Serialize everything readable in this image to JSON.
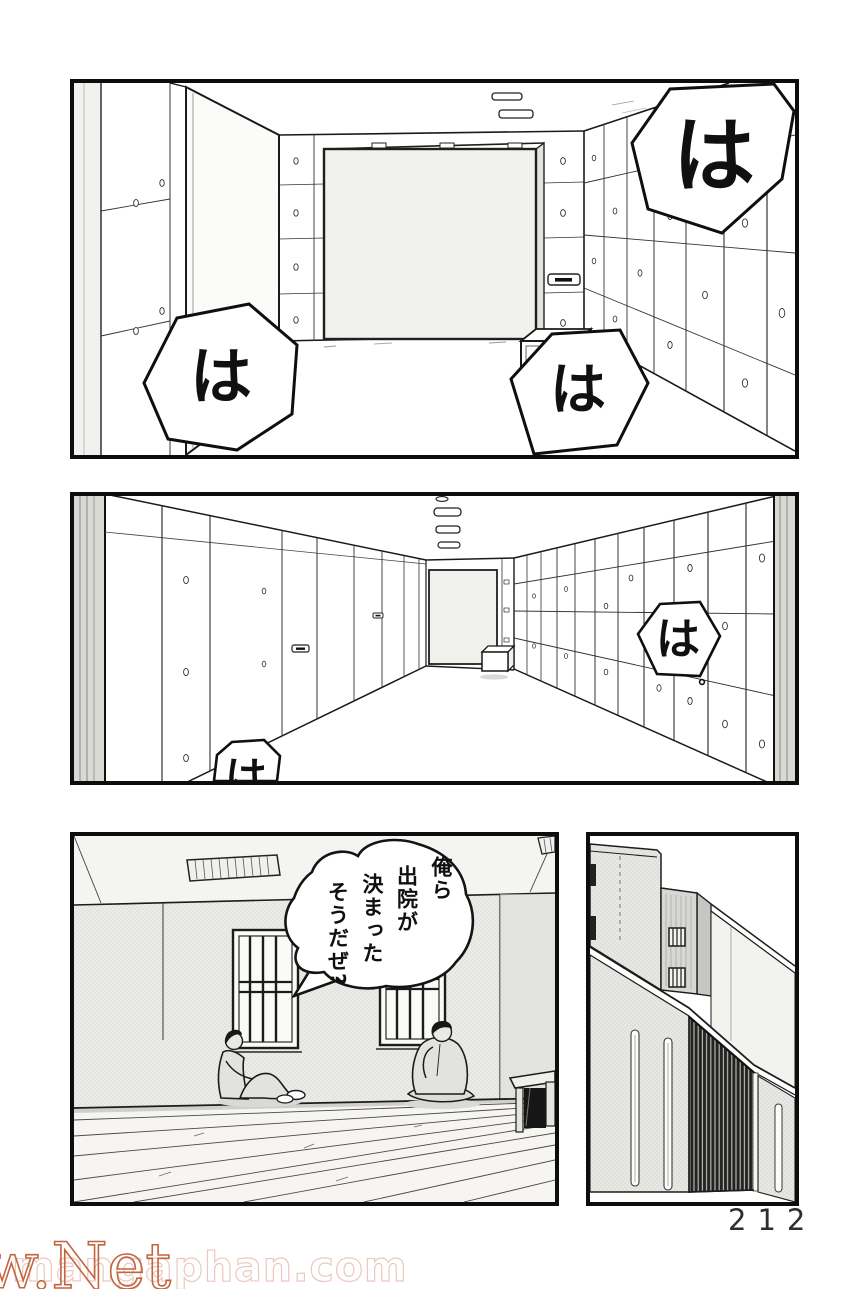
{
  "page": {
    "number": "212"
  },
  "watermark": {
    "large": "w.Net",
    "small": "mangaphan.com"
  },
  "panels": {
    "panel1": {
      "sfx": [
        "は",
        "は",
        "は"
      ]
    },
    "panel2": {
      "sfx": [
        "は",
        "は"
      ]
    },
    "panel3": {
      "dialogue": [
        "俺ら",
        "出院が",
        "決まった",
        "そうだぜ?"
      ]
    },
    "panel4": {}
  }
}
